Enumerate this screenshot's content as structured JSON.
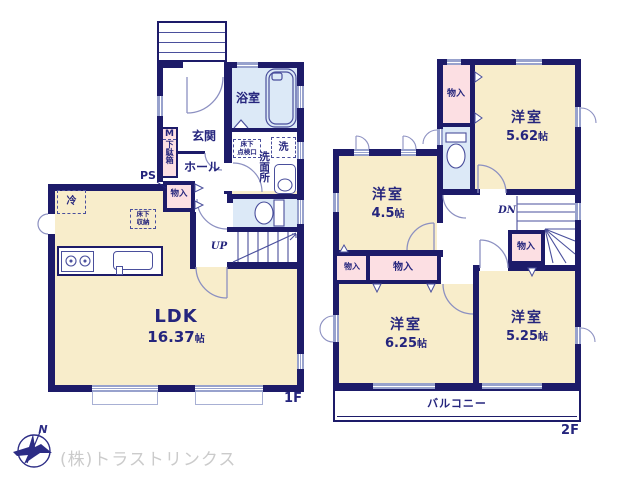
{
  "palette": {
    "wall": "#1d1b69",
    "room_cream": "#f8edcb",
    "closet_pink": "#fcdfe3",
    "wet_blue": "#dce9f7",
    "window_line": "#98a2cd",
    "door_arc": "#8c90c1",
    "fixture_line": "#4a4f9c",
    "text_navy": "#25257d",
    "watermark_gray": "#cbcbcb"
  },
  "shared": {
    "closet": "物入"
  },
  "f1": {
    "label": "1F",
    "entrance": "玄関",
    "hall": "ホール",
    "bathroom": "浴室",
    "washroom": "洗面所",
    "laundry": "洗",
    "ps": "PS",
    "fridge": "冷",
    "up": "UP",
    "shoe_m": "M",
    "shoe_cabinet": "下駄箱",
    "underfloor_hatch": [
      "床下",
      "点検口"
    ],
    "underfloor_storage": [
      "床下",
      "収納"
    ],
    "ldk": {
      "name": "LDK",
      "num": "16.37",
      "unit": "帖"
    }
  },
  "f2": {
    "label": "2F",
    "dn": "DN",
    "balcony": "バルコニー",
    "rooms": [
      {
        "name": "洋室",
        "num": "5.62",
        "unit": "帖"
      },
      {
        "name": "洋室",
        "num": "4.5",
        "unit": "帖"
      },
      {
        "name": "洋室",
        "num": "6.25",
        "unit": "帖"
      },
      {
        "name": "洋室",
        "num": "5.25",
        "unit": "帖"
      }
    ]
  },
  "footer": {
    "company": "(株)トラストリンクス",
    "compass": "N"
  }
}
